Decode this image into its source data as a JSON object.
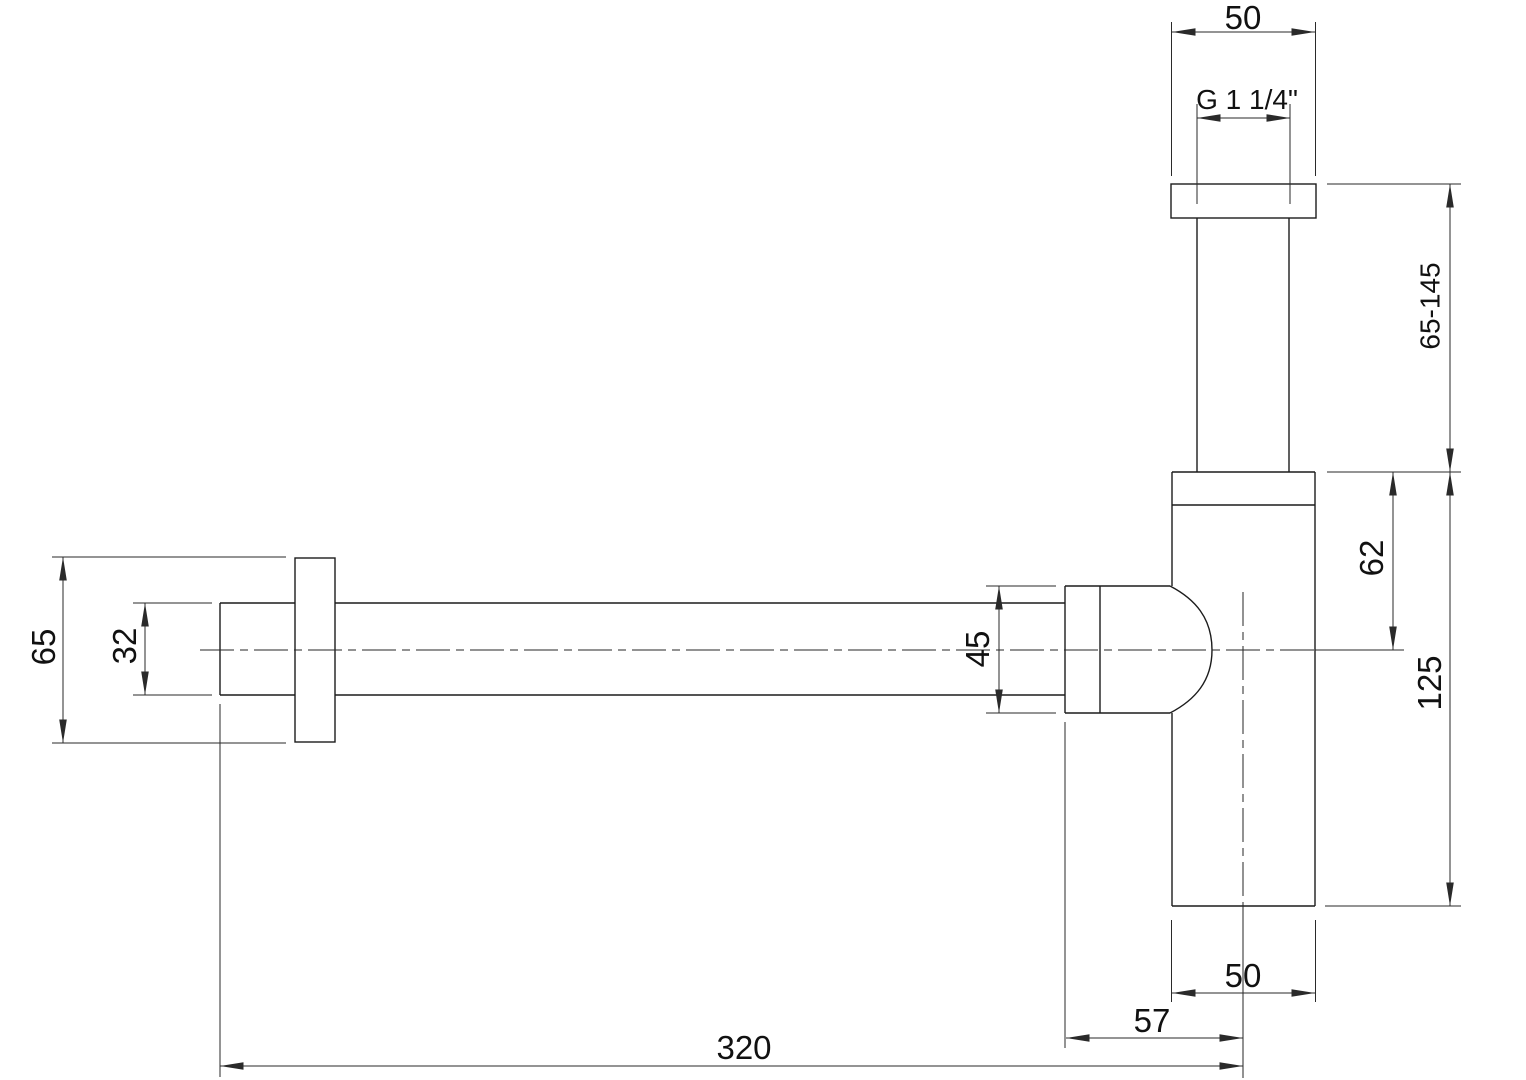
{
  "drawing": {
    "type": "technical-dimension-drawing",
    "subject": "bottle-trap-siphon-side-view",
    "colors": {
      "background": "#ffffff",
      "outline": "#1c1c1c",
      "dimension_lines": "#2a2a2a",
      "text": "#111111"
    },
    "labels": {
      "top_flange_width": "50",
      "thread_size": "G 1 1/4\"",
      "adjustable_height": "65-145",
      "body_top_to_center": "62",
      "body_height": "125",
      "body_width": "50",
      "nut_to_center": "57",
      "wall_to_center": "320",
      "wall_flange_diameter": "65",
      "wall_tube_diameter": "32",
      "nut_diameter": "45"
    }
  }
}
